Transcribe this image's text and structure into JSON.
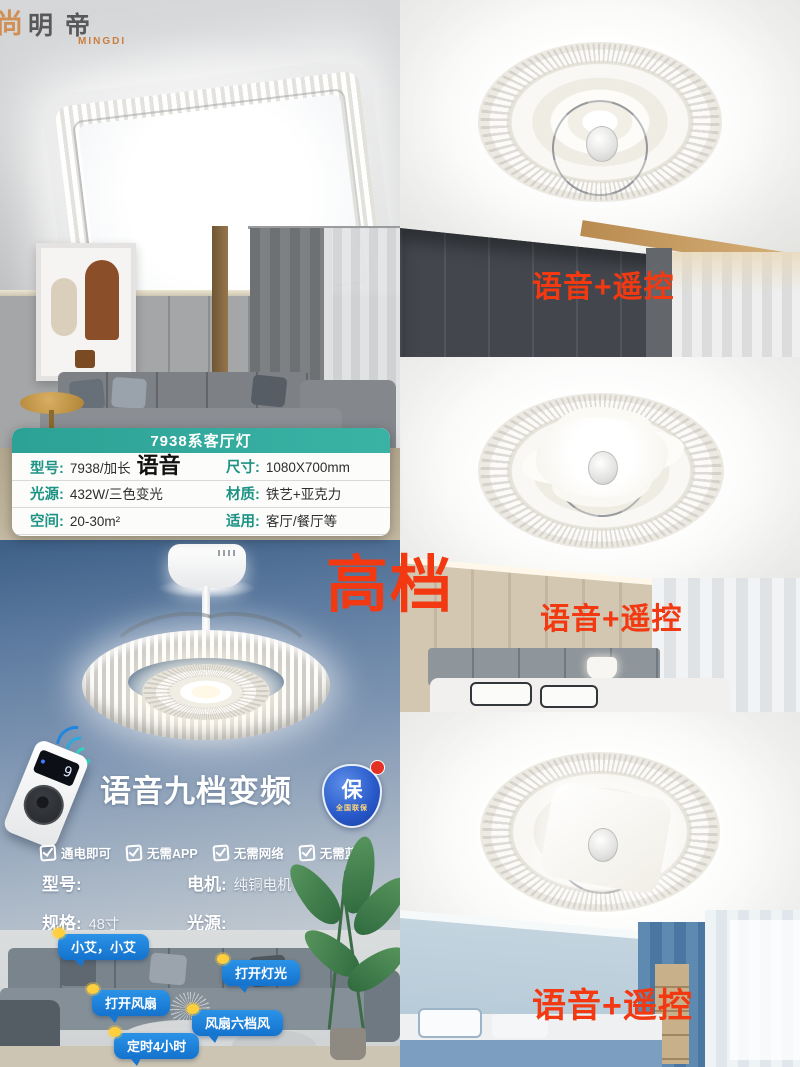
{
  "brand": {
    "mark": "尚",
    "cn": "明帝",
    "en": "MINGDI"
  },
  "premium_label": "高档",
  "spec_card": {
    "title": "7938系客厅灯",
    "rows": [
      {
        "l_label": "型号:",
        "l_value": "7938/加长",
        "l_extra": "语音",
        "r_label": "尺寸:",
        "r_value": "1080X700mm"
      },
      {
        "l_label": "光源:",
        "l_value": "432W/三色变光",
        "l_extra": "",
        "r_label": "材质:",
        "r_value": "铁艺+亚克力"
      },
      {
        "l_label": "空间:",
        "l_value": "20-30m²",
        "l_extra": "",
        "r_label": "适用:",
        "r_value": "客厅/餐厅等"
      }
    ]
  },
  "product": {
    "headline": "语音九档变频",
    "remote_display": "9",
    "badge": {
      "main": "保",
      "sub": "全国联保"
    },
    "features": [
      {
        "label": "通电即可"
      },
      {
        "label": "无需APP"
      },
      {
        "label": "无需网络"
      },
      {
        "label": "无需蓝牙"
      }
    ],
    "specs": [
      {
        "label": "型号:",
        "value": ""
      },
      {
        "label": "电机:",
        "value": "纯铜电机"
      },
      {
        "label": "规格:",
        "value": "48寸"
      },
      {
        "label": "光源:",
        "value": ""
      }
    ],
    "voice_bubbles": [
      {
        "text": "小艾，小艾"
      },
      {
        "text": "打开灯光"
      },
      {
        "text": "打开风扇"
      },
      {
        "text": "风扇六档风"
      },
      {
        "text": "定时4小时"
      }
    ]
  },
  "right_photos": [
    {
      "overlay": "语音+遥控"
    },
    {
      "overlay": "语音+遥控"
    },
    {
      "overlay": "语音+遥控"
    }
  ],
  "colors": {
    "accent_red": "#f23911",
    "teal_header": "#2ca195",
    "teal_label": "#1c9384",
    "bubble_blue": "#1d83db",
    "badge_blue": "#2757c8",
    "wifi_cyan": "#2baade"
  }
}
